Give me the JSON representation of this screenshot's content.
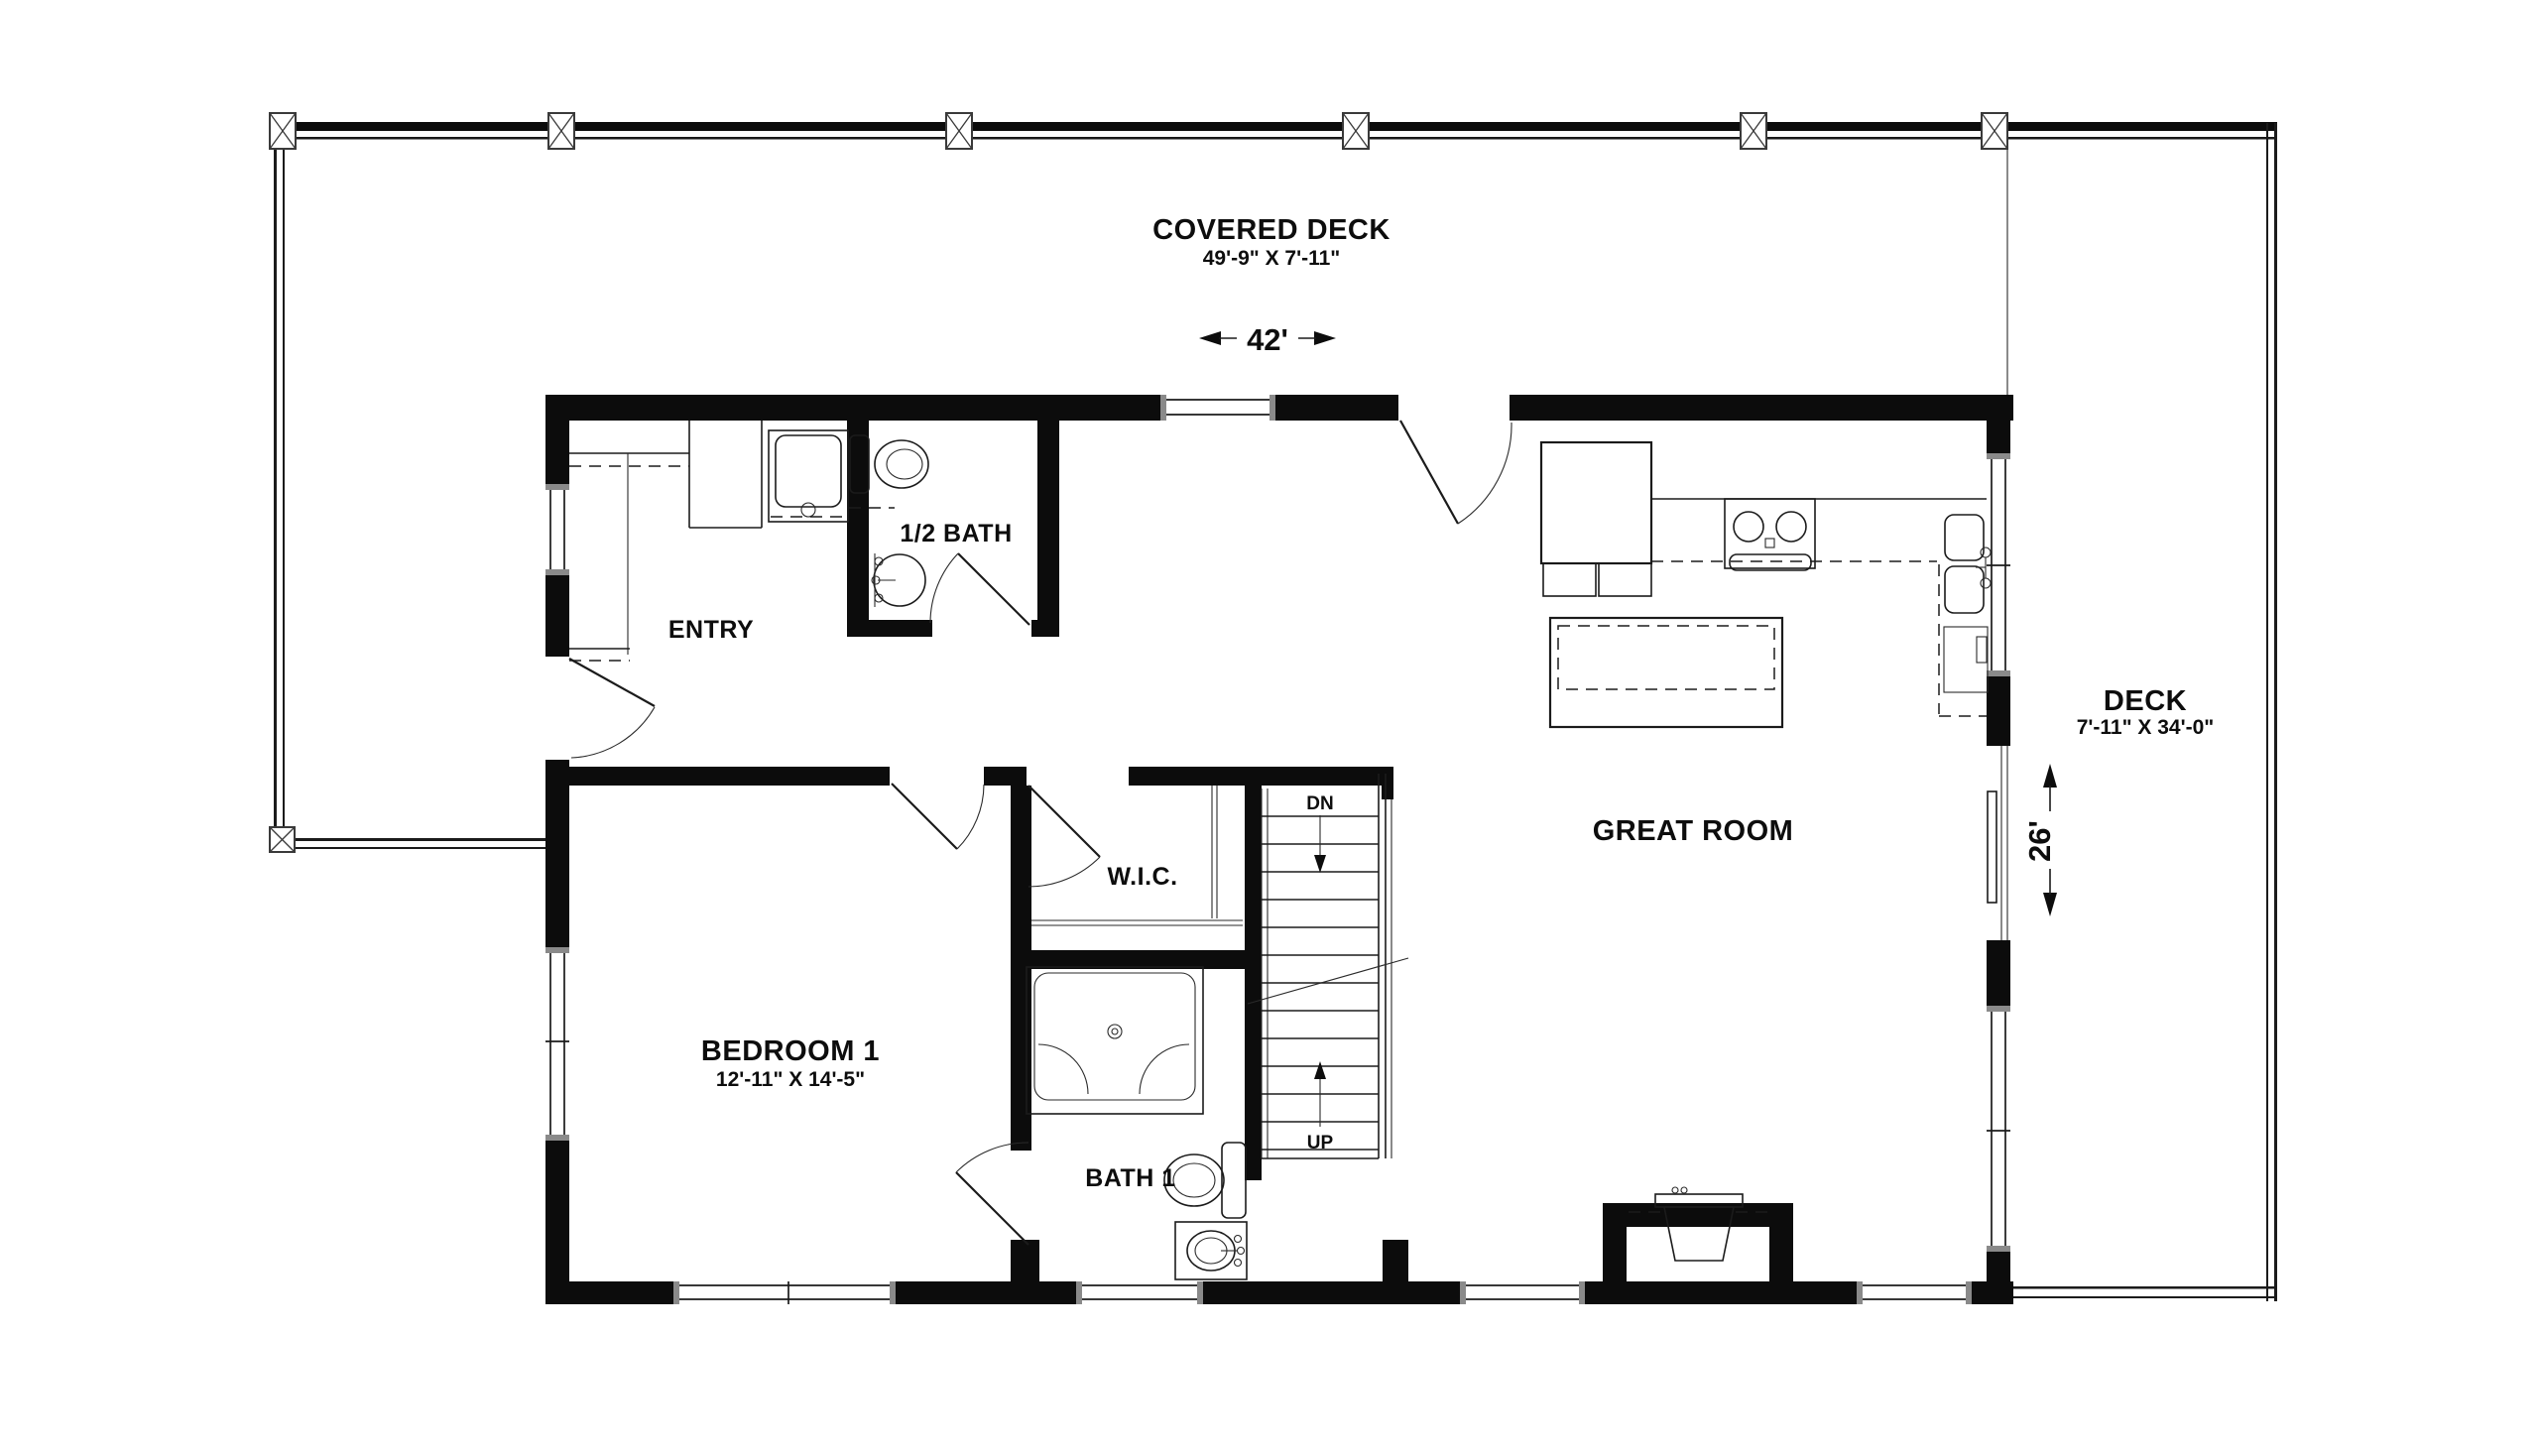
{
  "colors": {
    "background": "#ffffff",
    "ink": "#0d0d0d"
  },
  "labels": {
    "covered_deck": {
      "name": "COVERED DECK",
      "dims": "49'-9\" X 7'-11\""
    },
    "side_deck": {
      "name": "DECK",
      "dims": "7'-11\" X 34'-0\""
    },
    "dim_width": "42'",
    "dim_depth": "26'",
    "entry": "ENTRY",
    "half_bath": "1/2 BATH",
    "great_room": "GREAT ROOM",
    "wic": "W.I.C.",
    "bedroom1": {
      "name": "BEDROOM 1",
      "dims": "12'-11\" X 14'-5\""
    },
    "bath1": "BATH 1",
    "stairs": {
      "down": "DN",
      "up": "UP"
    }
  }
}
